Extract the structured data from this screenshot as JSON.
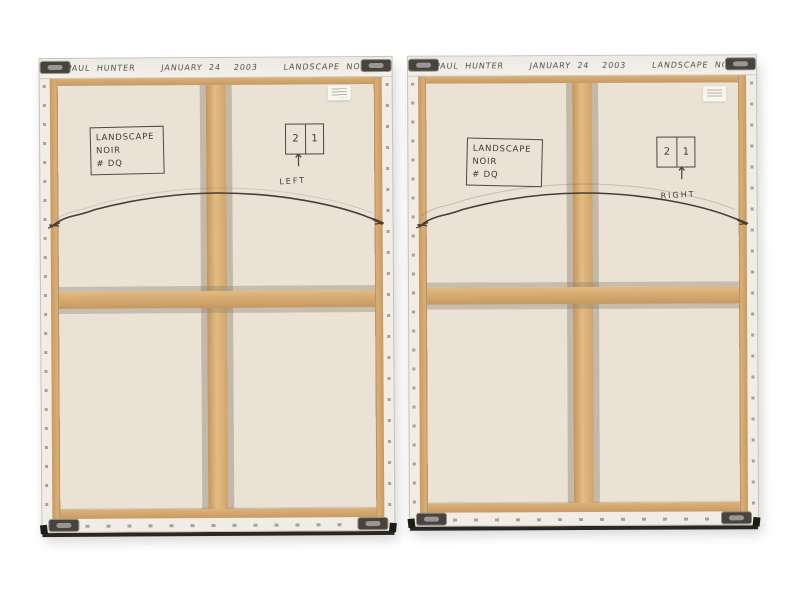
{
  "scene": {
    "background": "#ffffff"
  },
  "canvases": [
    {
      "side": "left",
      "inscription": "PAUL HUNTER    JANUARY 24  2003    LANDSCAPE NOIR - DQ",
      "label_box": {
        "line1": "LANDSCAPE",
        "line2": "NOIR",
        "line3": "# DQ"
      },
      "diagram": {
        "cell_left": "2",
        "cell_right": "1",
        "arrow": "↑",
        "caption": "LEFT"
      }
    },
    {
      "side": "right",
      "inscription": "PAUL HUNTER    JANUARY 24  2003    LANDSCAPE NOIR - DQ",
      "label_box": {
        "line1": "LANDSCAPE",
        "line2": "NOIR",
        "line3": "# DQ"
      },
      "diagram": {
        "cell_left": "2",
        "cell_right": "1",
        "arrow": "↑",
        "caption": "RIGHT"
      }
    }
  ],
  "colors": {
    "canvas_cream": "#e9e2d5",
    "edge_white": "#f0ede6",
    "wood_tan": "#d8ac72",
    "wire": "#473e35",
    "graphite": "#57534b",
    "bracket_metal": "#47443f"
  }
}
